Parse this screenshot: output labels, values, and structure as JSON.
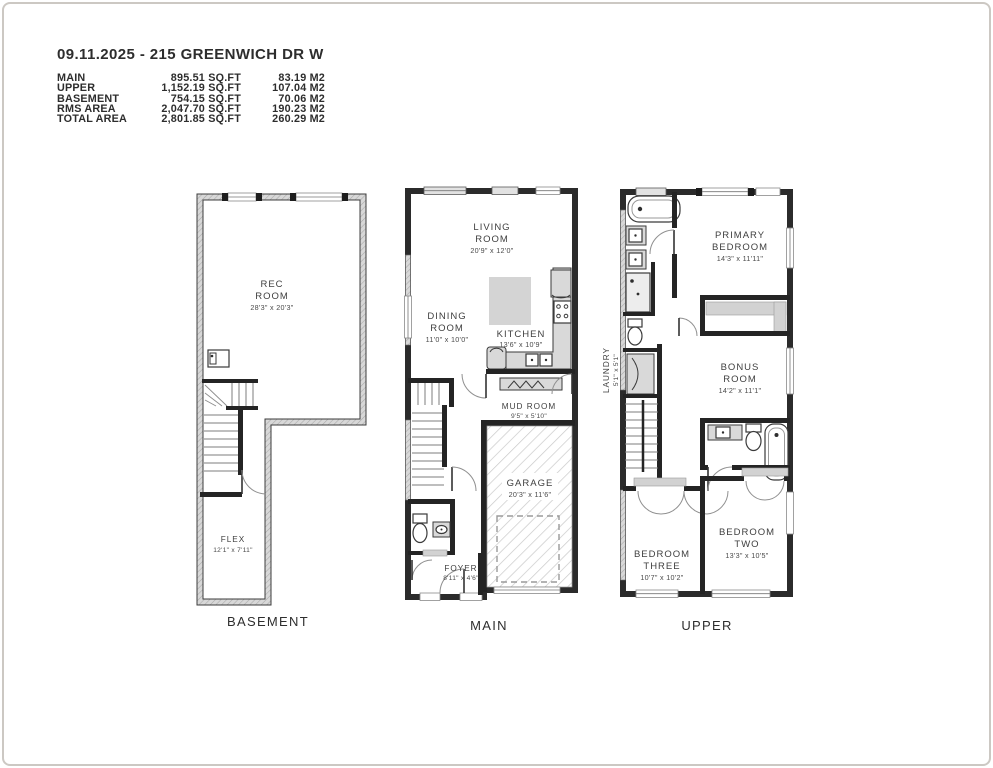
{
  "header": {
    "title": "09.11.2025 - 215 GREENWICH DR W",
    "area_rows": [
      {
        "label": "MAIN",
        "sqft": "895.51 SQ.FT",
        "m2": "83.19 M2"
      },
      {
        "label": "UPPER",
        "sqft": "1,152.19 SQ.FT",
        "m2": "107.04 M2"
      },
      {
        "label": "BASEMENT",
        "sqft": "754.15 SQ.FT",
        "m2": "70.06 M2"
      },
      {
        "label": "RMS AREA",
        "sqft": "2,047.70 SQ.FT",
        "m2": "190.23 M2"
      },
      {
        "label": "TOTAL AREA",
        "sqft": "2,801.85 SQ.FT",
        "m2": "260.29 M2"
      }
    ]
  },
  "floors": {
    "basement": {
      "label": "BASEMENT",
      "rooms": {
        "rec": {
          "l1": "REC",
          "l2": "ROOM",
          "dims": "28'3\" x 20'3\""
        },
        "flex": {
          "l1": "FLEX",
          "dims": "12'1\" x 7'11\""
        }
      }
    },
    "main": {
      "label": "MAIN",
      "rooms": {
        "living": {
          "l1": "LIVING",
          "l2": "ROOM",
          "dims": "20'9\" x 12'0\""
        },
        "dining": {
          "l1": "DINING",
          "l2": "ROOM",
          "dims": "11'0\" x 10'0\""
        },
        "kitchen": {
          "l1": "KITCHEN",
          "dims": "13'6\" x 10'9\""
        },
        "mud": {
          "l1": "MUD ROOM",
          "dims": "9'5\" x 5'10\""
        },
        "garage": {
          "l1": "GARAGE",
          "dims": "20'3\" x 11'6\""
        },
        "foyer": {
          "l1": "FOYER",
          "dims": "8'11\" x 4'6\""
        }
      }
    },
    "upper": {
      "label": "UPPER",
      "rooms": {
        "primary": {
          "l1": "PRIMARY",
          "l2": "BEDROOM",
          "dims": "14'3\" x 11'11\""
        },
        "laundry": {
          "l1": "LAUNDRY",
          "dims": "5'1\" x 5'1\""
        },
        "bonus": {
          "l1": "BONUS",
          "l2": "ROOM",
          "dims": "14'2\" x 11'1\""
        },
        "bed3": {
          "l1": "BEDROOM",
          "l2": "THREE",
          "dims": "10'7\" x 10'2\""
        },
        "bed2": {
          "l1": "BEDROOM",
          "l2": "TWO",
          "dims": "13'3\" x 10'5\""
        }
      }
    }
  },
  "colors": {
    "wall": "#2b2b2b",
    "wall_hatch_bg": "#d8d8d8",
    "wall_hatch_line": "#a8a8a8",
    "garage_hatch_line": "#c9c9c9",
    "fixture_fill": "#d9d9d9",
    "text": "#3f3f3f",
    "frame": "#ccc8c3"
  }
}
